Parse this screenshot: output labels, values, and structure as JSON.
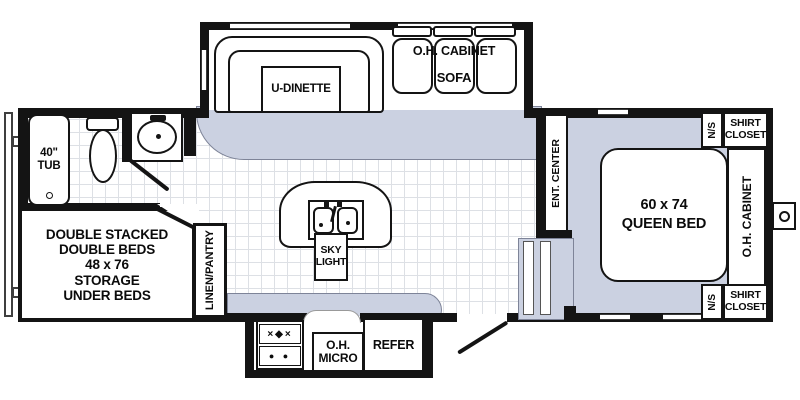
{
  "diagram": "travel-trailer-floor-plan",
  "colors": {
    "carpet": "#cbd1e1",
    "wall": "#141414",
    "tile_grid_line": "#dde0e5",
    "floor": "#ffffff"
  },
  "labels": {
    "tub": "40\"\nTUB",
    "double_beds": "DOUBLE STACKED\nDOUBLE BEDS\n48 x 76\nSTORAGE\nUNDER BEDS",
    "linen_pantry": "LINEN/PANTRY",
    "u_dinette": "U-DINETTE",
    "sofa_oh_cabinet": "O.H. CABINET",
    "sofa": "SOFA",
    "sky_light": "SKY\nLIGHT",
    "oh_micro": "O.H.\nMICRO",
    "refer": "REFER",
    "ent_center": "ENT. CENTER",
    "queen_bed": "60 x 74\nQUEEN BED",
    "ns_top": "N/S",
    "ns_bottom": "N/S",
    "shirt_closet_top": "SHIRT\nCLOSET",
    "shirt_closet_bottom": "SHIRT\nCLOSET",
    "oh_cabinet_bedroom": "O.H. CABINET"
  },
  "icons": {
    "stove_burner_row_top": "×◆×",
    "stove_burner_row_bottom": "● ●"
  }
}
